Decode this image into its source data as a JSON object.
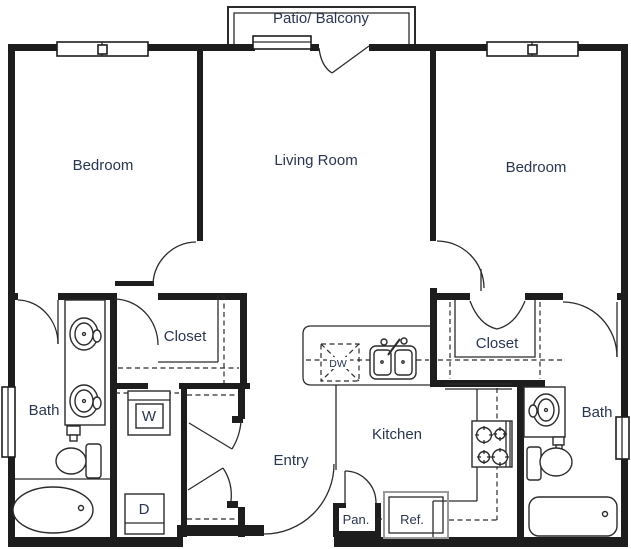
{
  "floorplan": {
    "rooms": {
      "patio": "Patio/ Balcony",
      "bedroom_left": "Bedroom",
      "living_room": "Living Room",
      "bedroom_right": "Bedroom",
      "closet_left": "Closet",
      "closet_right": "Closet",
      "bath_left": "Bath",
      "bath_right": "Bath",
      "kitchen": "Kitchen",
      "entry": "Entry"
    },
    "appliances": {
      "washer": "W",
      "dryer": "D",
      "dishwasher": "DW",
      "pantry": "Pan.",
      "refrigerator": "Ref."
    },
    "colors": {
      "wall": "#1d1d1d",
      "line": "#2b2b2b",
      "label_text": "#293650",
      "appliance_gray": "#9a9a9a",
      "background": "#ffffff"
    }
  }
}
